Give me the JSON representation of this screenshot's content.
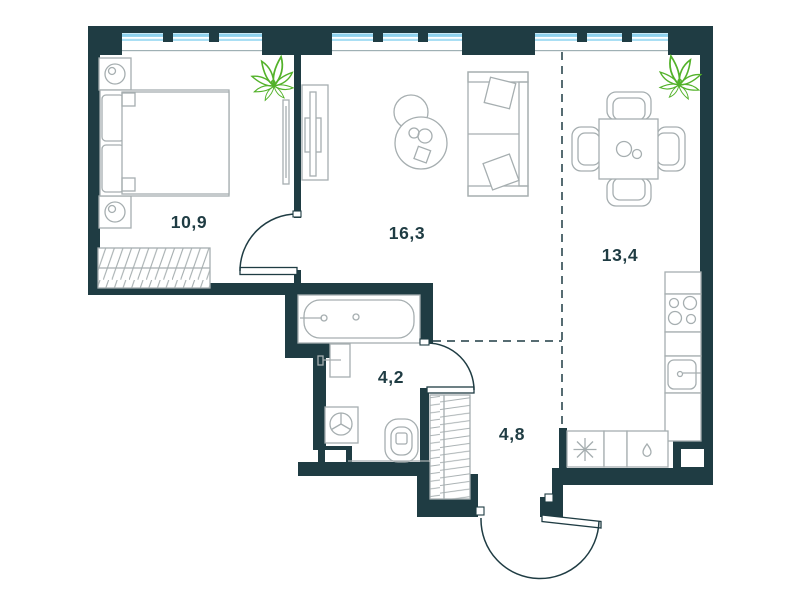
{
  "plan": {
    "title": "apartment-floor-plan",
    "rooms": [
      {
        "name": "bedroom",
        "area": "10,9"
      },
      {
        "name": "living-room",
        "area": "16,3"
      },
      {
        "name": "dining-kitchen",
        "area": "13,4"
      },
      {
        "name": "bathroom",
        "area": "4,2"
      },
      {
        "name": "hallway",
        "area": "4,8"
      }
    ],
    "fixtures": [
      "double-bed",
      "nightstand-lamp-left",
      "nightstand-lamp-right",
      "bedroom-wardrobe",
      "bedroom-tv",
      "tv-stand",
      "coffee-table-pair",
      "sofa",
      "plant-bedroom",
      "plant-dining",
      "dining-table-with-chairs",
      "cooktop",
      "kitchen-sink",
      "kitchen-counter",
      "dishwasher-asterisk",
      "water-drop-unit",
      "bathtub",
      "washbasin",
      "washing-machine",
      "toilet",
      "hall-closet",
      "entrance-door",
      "bedroom-door",
      "bathroom-door",
      "windows",
      "zoning-dashed-line"
    ],
    "colors": {
      "wall": "#1f3c43",
      "window_glass": "#8ed2ee",
      "furniture_line": "#a6aeb0",
      "plant": "#53b22a",
      "label": "#1f3c43",
      "background": "#ffffff"
    }
  }
}
